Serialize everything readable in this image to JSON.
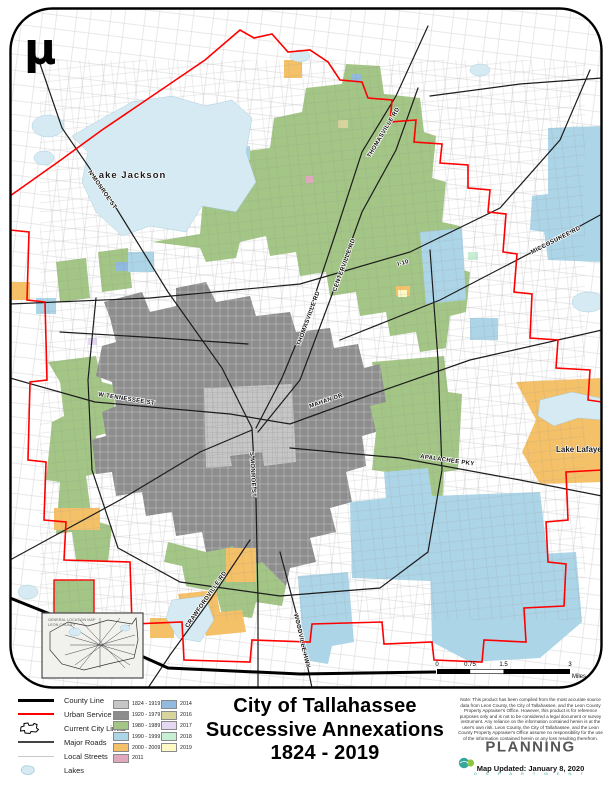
{
  "colors": {
    "1824": "#C6C6C6",
    "1920": "#8D8D8D",
    "1980": "#A3C585",
    "1990": "#ADD5E8",
    "2000": "#F5C168",
    "2011": "#DFA8BC",
    "2014": "#92B9DE",
    "2016": "#D8D49E",
    "2017": "#E5D8F2",
    "2018": "#C8EFD4",
    "2019": "#FDFAC8",
    "lake": "#D5EAF2",
    "usa": "#FF0000",
    "road": "#1C1C1C",
    "street": "#C9C9C9"
  },
  "map": {
    "north_arrow": "µ",
    "labels": {
      "lake_jackson": "Lake Jackson",
      "lake_lafayette": "Lake Lafayette",
      "n_monroe": "N MONROE ST",
      "s_monroe": "S MONROE ST",
      "thomasville_1": "THOMASVILLE RD",
      "thomasville_2": "THOMASVILLE RD",
      "centerville": "CENTERVILLE RD",
      "tennessee": "W TENNESSEE ST",
      "mahan": "MAHAN DR",
      "apalachee": "APALACHEE PKY",
      "i10": "I-10",
      "miccosukee": "MICCOSUKEE RD",
      "crawfordville": "CRAWFORDVILLE RD",
      "woodville": "WOODVILLE HWY"
    },
    "inset": {
      "line1": "GENERAL LOCATION MAP",
      "line2": "LEON COUNTY"
    },
    "scalebar": {
      "t0": "0",
      "t1": "0.75",
      "t2": "1.5",
      "t3": "3",
      "unit": "Miles"
    }
  },
  "legend": {
    "lines": [
      {
        "label": "County Line"
      },
      {
        "label": "Urban Service Area"
      },
      {
        "label": "Current City Limits"
      },
      {
        "label": "Major Roads"
      },
      {
        "label": "Local Streets"
      },
      {
        "label": "Lakes"
      }
    ],
    "periods_col1": [
      {
        "label": "1824 - 1919"
      },
      {
        "label": "1920 - 1979"
      },
      {
        "label": "1980 - 1989"
      },
      {
        "label": "1990 - 1999"
      },
      {
        "label": "2000 - 2009"
      },
      {
        "label": "2011"
      }
    ],
    "periods_col2": [
      {
        "label": "2014"
      },
      {
        "label": "2016"
      },
      {
        "label": "2017"
      },
      {
        "label": "2018"
      },
      {
        "label": "2019"
      }
    ]
  },
  "title": {
    "line1": "City of Tallahassee",
    "line2": "Successive Annexations",
    "line3": "1824 - 2019"
  },
  "footer": {
    "note": "Note: This product has been compiled from the most accurate source data from Leon County, the City of Tallahassee, and the Leon County Property Appraiser's Office. However, this product is for reference purposes only and is not to be considered a legal document or survey instrument. Any reliance on the information contained herein is at the user's own risk. Leon County, the City of Tallahassee, and the Leon County Property Appraiser's Office assume no responsibility for the use of the information contained herein or any loss resulting therefrom.",
    "logo": "PLANNING",
    "logo_sub": "D E P A R T M E N T",
    "updated": "Map Updated: January 8, 2020"
  }
}
